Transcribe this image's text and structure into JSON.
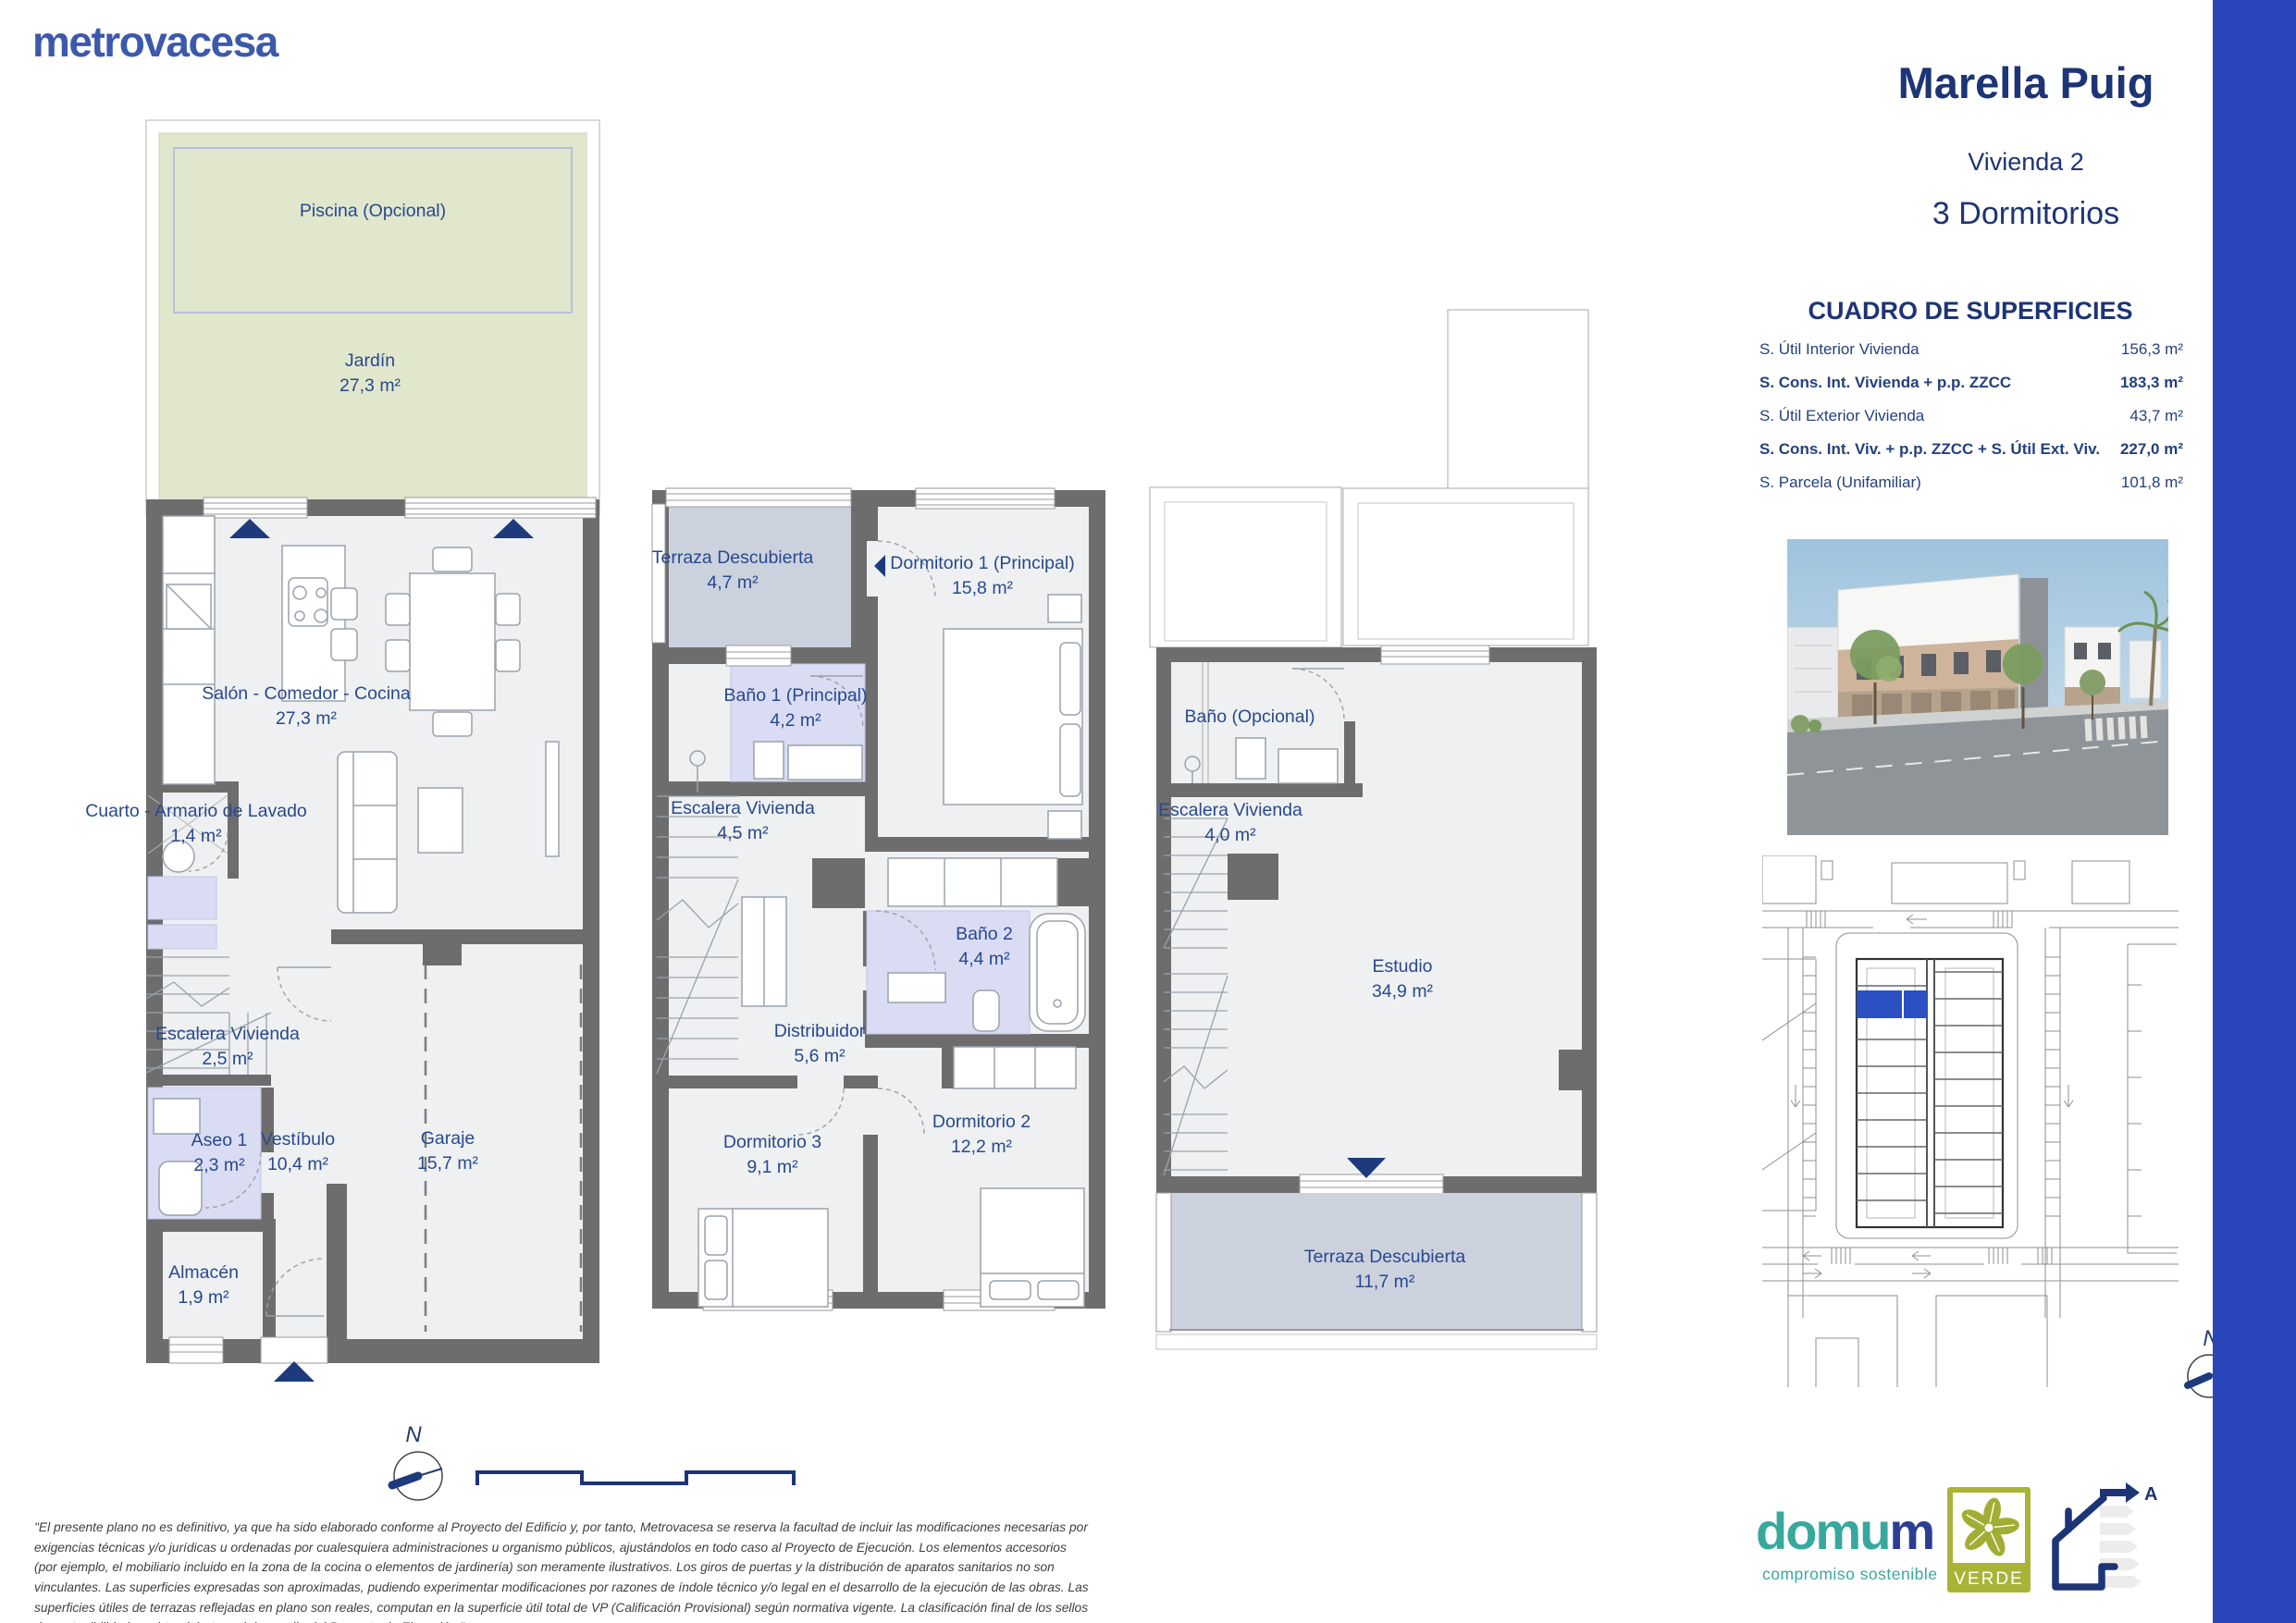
{
  "brand": {
    "logo": "metrovacesa"
  },
  "header": {
    "project": "Marella Puig",
    "unit": "Vivienda 2",
    "type": "3 Dormitorios"
  },
  "surfaces": {
    "title": "CUADRO DE SUPERFICIES",
    "rows": [
      {
        "label": "S. Útil Interior Vivienda",
        "value": "156,3 m²",
        "bold": false
      },
      {
        "label": "S. Cons. Int. Vivienda + p.p. ZZCC",
        "value": "183,3 m²",
        "bold": true
      },
      {
        "label": "S. Útil Exterior Vivienda",
        "value": "43,7 m²",
        "bold": false
      },
      {
        "label": "S. Cons. Int. Viv. + p.p. ZZCC + S. Útil Ext. Viv.",
        "value": "227,0 m²",
        "bold": true
      },
      {
        "label": "S. Parcela (Unifamiliar)",
        "value": "101,8 m²",
        "bold": false
      }
    ]
  },
  "floor0": {
    "piscina": {
      "label": "Piscina (Opcional)"
    },
    "jardin": {
      "label": "Jardín",
      "area": "27,3 m²"
    },
    "salon": {
      "label": "Salón - Comedor - Cocina",
      "area": "27,3 m²"
    },
    "lavado": {
      "label": "Cuarto - Armario de Lavado",
      "area": "1,4 m²"
    },
    "escalera": {
      "label": "Escalera Vivienda",
      "area": "2,5 m²"
    },
    "aseo": {
      "label": "Aseo 1",
      "area": "2,3 m²"
    },
    "vestibulo": {
      "label": "Vestíbulo",
      "area": "10,4 m²"
    },
    "garaje": {
      "label": "Garaje",
      "area": "15,7 m²"
    },
    "almacen": {
      "label": "Almacén",
      "area": "1,9 m²"
    }
  },
  "floor1": {
    "terraza": {
      "label": "Terraza Descubierta",
      "area": "4,7 m²"
    },
    "dorm1": {
      "label": "Dormitorio 1 (Principal)",
      "area": "15,8 m²"
    },
    "bano1": {
      "label": "Baño 1 (Principal)",
      "area": "4,2 m²"
    },
    "escalera": {
      "label": "Escalera Vivienda",
      "area": "4,5 m²"
    },
    "bano2": {
      "label": "Baño 2",
      "area": "4,4 m²"
    },
    "distribuidor": {
      "label": "Distribuidor",
      "area": "5,6 m²"
    },
    "dorm3": {
      "label": "Dormitorio 3",
      "area": "9,1 m²"
    },
    "dorm2": {
      "label": "Dormitorio 2",
      "area": "12,2 m²"
    }
  },
  "floor2": {
    "bano": {
      "label": "Baño (Opcional)"
    },
    "escalera": {
      "label": "Escalera Vivienda",
      "area": "4,0 m²"
    },
    "estudio": {
      "label": "Estudio",
      "area": "34,9 m²"
    },
    "terraza": {
      "label": "Terraza Descubierta",
      "area": "11,7 m²"
    }
  },
  "compass": {
    "north": "N"
  },
  "footer": {
    "disclaimer": "\"El presente plano no es definitivo, ya que ha sido elaborado conforme al Proyecto del Edificio y, por tanto, Metrovacesa se reserva la facultad de incluir las modificaciones necesarias por exigencias técnicas y/o jurídicas u ordenadas por cualesquiera administraciones u organismo públicos, ajustándolos en todo caso al Proyecto de Ejecución. Los elementos accesorios (por ejemplo, el mobiliario incluido en la zona de la cocina o elementos de jardinería) son meramente ilustrativos. Los giros de puertas y la distribución de aparatos sanitarios no son vinculantes. Las superficies expresadas son aproximadas, pudiendo experimentar modificaciones por razones de índole técnico y/o legal en el desarrollo de la ejecución de las obras. Las superficies útiles de terrazas reflejadas en plano son reales, computan en la superficie útil total de VP (Calificación Provisional) según normativa vigente. La clasificación final de los sellos de sostenibilidad se obtendrán tras el desarrollo del Proyecto de Ejecución.\""
  },
  "logos": {
    "domum": {
      "part1": "domu",
      "part2": "m",
      "tagline": "compromiso sostenible"
    },
    "verde": {
      "label": "VERDE"
    },
    "energy": {
      "rating": "A"
    }
  },
  "colors": {
    "brand_blue": "#3d59ab",
    "navy": "#1d3476",
    "accent_bar": "#2946bb",
    "wall_gray": "#6d6d6d",
    "garden_green": "#e1e7cd",
    "terrace_blue": "#ccd1de",
    "bath_purple": "#dadcf4",
    "highlight_unit": "#2b50c4"
  }
}
